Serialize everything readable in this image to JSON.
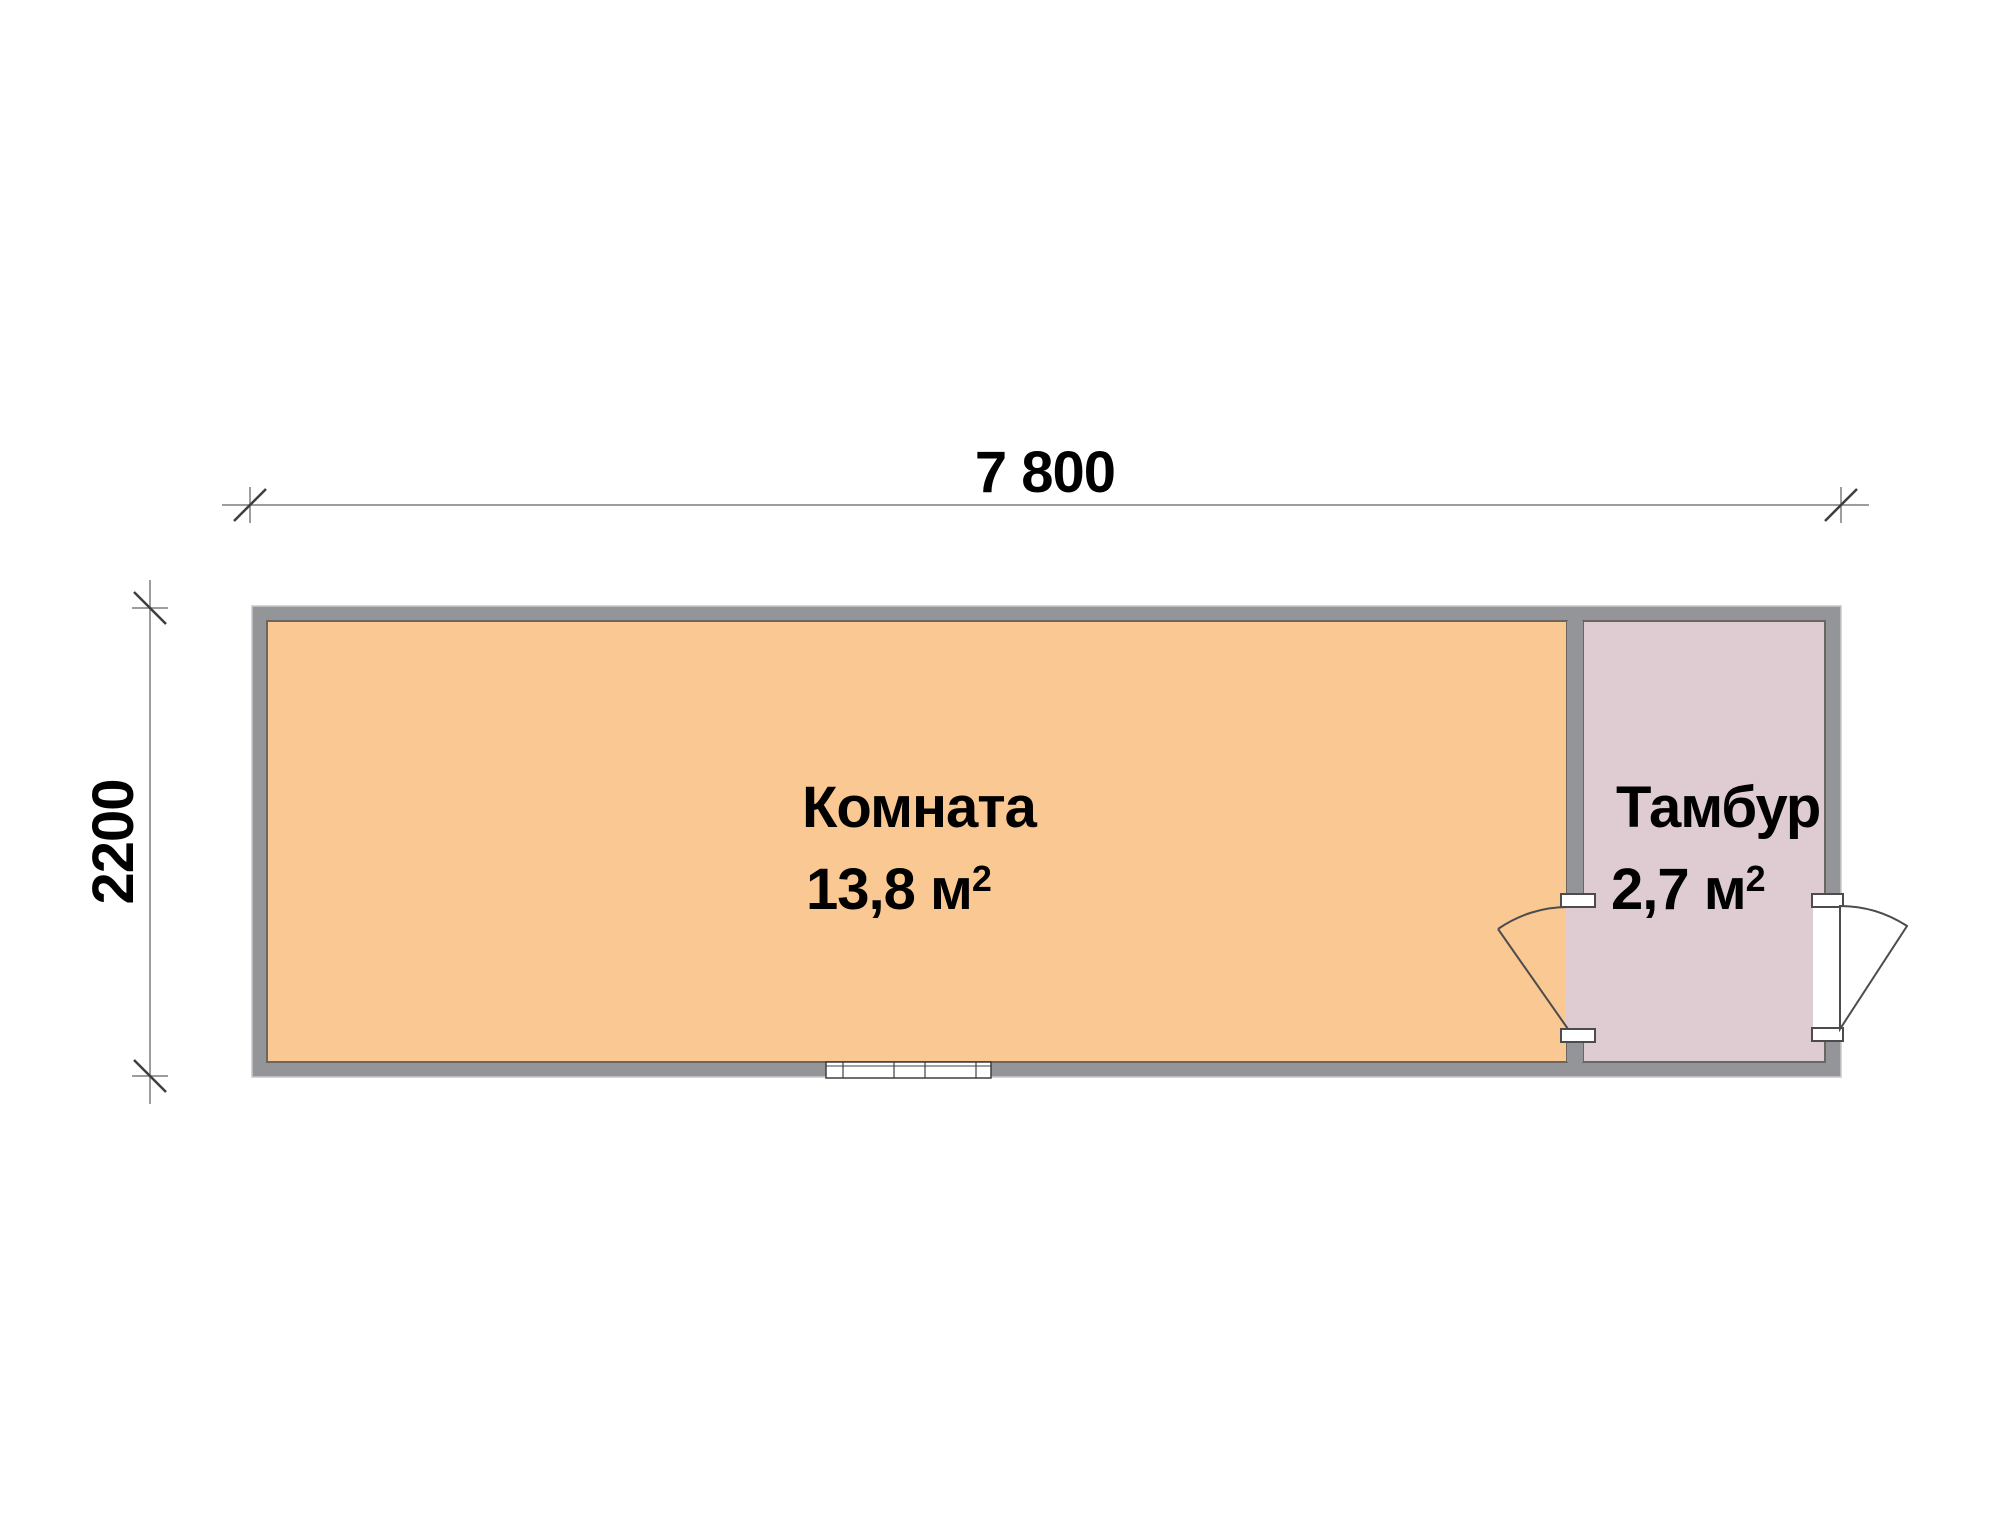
{
  "plan": {
    "dimension_top": {
      "label": "7 800"
    },
    "dimension_left": {
      "label": "2200"
    },
    "rooms": [
      {
        "name": "Комната",
        "area": "13,8 м",
        "area_sup": "2"
      },
      {
        "name": "Тамбур",
        "area": "2,7 м",
        "area_sup": "2"
      }
    ]
  },
  "colors": {
    "background": "#FFFFFF",
    "wall": "#939599",
    "wall_outline": "#C8C9CB",
    "room_main_fill": "#FAC893",
    "room_vestibule_fill": "#DECCD2",
    "interior_line": "#6B6760",
    "symbol_line": "#4C4C4E",
    "dim_line": "#7D7D7D",
    "dim_tick": "#3E3E3E",
    "text": "#000000"
  }
}
